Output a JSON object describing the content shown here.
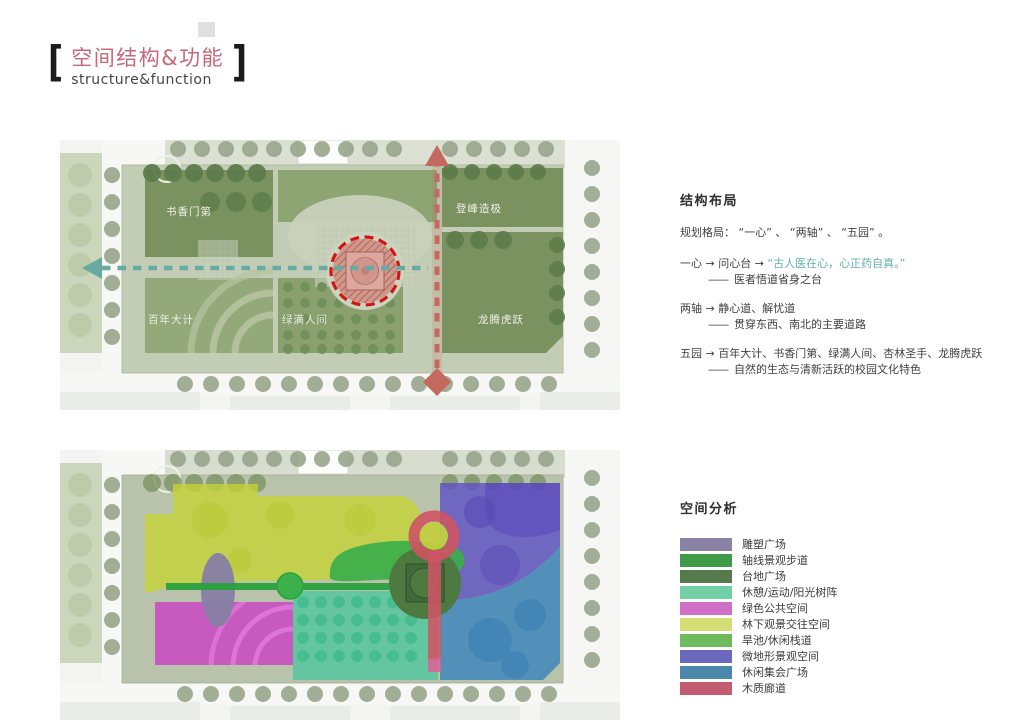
{
  "title": {
    "zh": "空间结构&功能",
    "en": "structure&function",
    "bracket_left": "[",
    "bracket_right": "]"
  },
  "structure_section": {
    "header": "结构布局",
    "intro": "规划格局： “一心” 、 “两轴” 、 “五园” 。",
    "items": [
      {
        "lead": "一心 → 问心台 → ",
        "highlight": "“古人医在心，心正药自真。”",
        "dash": "——",
        "desc": "医者悟道省身之台"
      },
      {
        "lead": "两轴 → 静心道、解忧道",
        "highlight": "",
        "dash": "——",
        "desc": "贯穿东西、南北的主要道路"
      },
      {
        "lead": "五园 → 百年大计、书香门第、绿满人间、杏林圣手、龙腾虎跃",
        "highlight": "",
        "dash": "——",
        "desc": "自然的生态与清新活跃的校园文化特色"
      }
    ]
  },
  "analysis_section": {
    "header": "空间分析",
    "legend": [
      {
        "label": "雕塑广场",
        "color": "#8b83a7"
      },
      {
        "label": "轴线景观步道",
        "color": "#3f9b48"
      },
      {
        "label": "台地广场",
        "color": "#567a4b"
      },
      {
        "label": "休憩/运动/阳光树阵",
        "color": "#70cfa4"
      },
      {
        "label": "绿色公共空间",
        "color": "#cf6fc8"
      },
      {
        "label": "林下观景交往空间",
        "color": "#d5dd75"
      },
      {
        "label": "旱池/休闲栈道",
        "color": "#6fba5f"
      },
      {
        "label": "微地形景观空间",
        "color": "#6b69be"
      },
      {
        "label": "休闲集会广场",
        "color": "#4c87ac"
      },
      {
        "label": "木质廊道",
        "color": "#c35c71"
      }
    ]
  },
  "structure_map": {
    "labels": {
      "shuxiangmendi": "书香门第",
      "dengfengzaoji": "登峰造极",
      "bainiandaji": "百年大计",
      "lvmanrenjian": "绿满人间",
      "longtenghuyue": "龙腾虎跃"
    }
  },
  "colors": {
    "title_accent": "#c76878",
    "highlight_teal": "#5fb3a8",
    "axis_teal": "#68aaa2",
    "axis_red": "#c4695e",
    "ring_red": "#d21414"
  }
}
